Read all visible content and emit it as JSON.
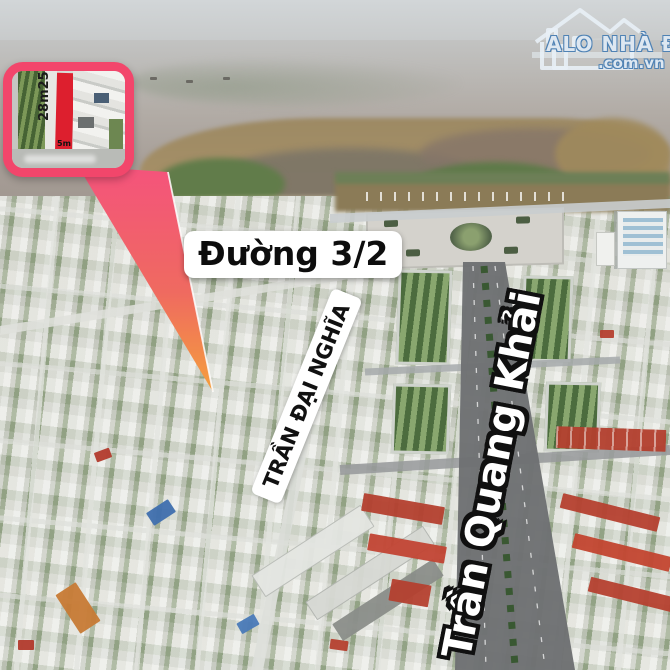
{
  "logo": {
    "brand": "ALO NHÀ ĐẤT",
    "site": ".com.vn",
    "icon": "house-outline"
  },
  "inset": {
    "depth_label": "28m25",
    "frontage_label": "5m"
  },
  "labels": {
    "street_32": "Đường 3/2",
    "tran_dai_nghia": "TRẦN ĐẠI NGHĨA",
    "tran_quang_khai": "Trần Quang Khải"
  },
  "colors": {
    "callout_pink": "#f2466b",
    "arrow_top": "#f4547b",
    "arrow_tip": "#f59f3c",
    "lot_red": "#dd1f2e",
    "label_bg": "#ffffff",
    "label_text": "#111111",
    "sea": "#a59c95",
    "boulevard": "#6e7173"
  }
}
